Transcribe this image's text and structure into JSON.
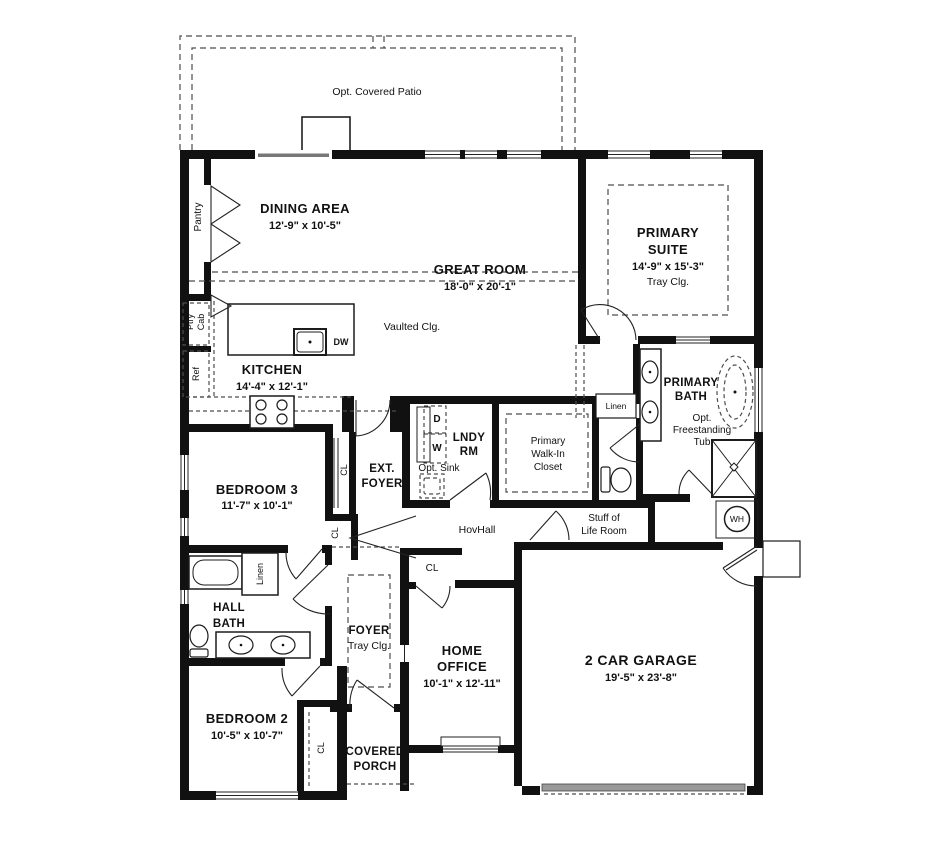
{
  "colors": {
    "wall": "#111111",
    "dash_line": "#4d4d4d",
    "garage_door_band": "#999999",
    "background": "#ffffff"
  },
  "labels": {
    "patio": "Opt. Covered Patio",
    "dining_name": "DINING AREA",
    "dining_dims": "12'-9\" x 10'-5\"",
    "great_name": "GREAT ROOM",
    "great_dims": "18'-0\" x 20'-1\"",
    "vaulted": "Vaulted Clg.",
    "kitchen_name": "KITCHEN",
    "kitchen_dims": "14'-4\" x 12'-1\"",
    "pantry": "Pantry",
    "ptry": "Ptry",
    "cab": "Cab",
    "ref": "Ref",
    "dw": "DW",
    "suite1": "PRIMARY",
    "suite2": "SUITE",
    "suite_dims": "14'-9\" x 15'-3\"",
    "suite_clg": "Tray Clg.",
    "bath1": "PRIMARY",
    "bath2": "BATH",
    "tub1": "Opt.",
    "tub2": "Freestanding",
    "tub3": "Tub",
    "linen": "Linen",
    "wic1": "Primary",
    "wic2": "Walk-In",
    "wic3": "Closet",
    "lndy1": "LNDY",
    "lndy2": "RM",
    "d": "D",
    "w": "W",
    "opt_sink": "Opt. Sink",
    "ext1": "EXT.",
    "ext2": "FOYER",
    "bed3_name": "BEDROOM 3",
    "bed3_dims": "11'-7\" x 10'-1\"",
    "hovhall": "HovHall",
    "stuff1": "Stuff of",
    "stuff2": "Life Room",
    "wh": "WH",
    "hb1": "HALL",
    "hb2": "BATH",
    "cl": "CL",
    "foyer_name": "FOYER",
    "foyer_clg": "Tray Clg.",
    "office1": "HOME",
    "office2": "OFFICE",
    "office_dims": "10'-1\" x 12'-11\"",
    "garage_name": "2 CAR GARAGE",
    "garage_dims": "19'-5\" x 23'-8\"",
    "bed2_name": "BEDROOM 2",
    "bed2_dims": "10'-5\" x 10'-7\"",
    "porch1": "COVERED",
    "porch2": "PORCH"
  }
}
